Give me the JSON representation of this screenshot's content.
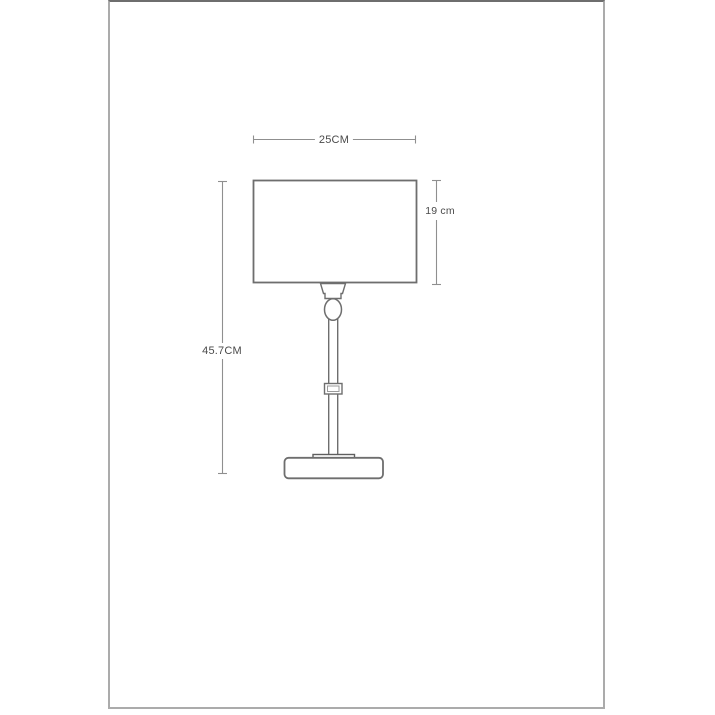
{
  "figure": {
    "type": "product-dimension-drawing",
    "subject": "table-lamp-line-drawing",
    "dimensions": {
      "width_label": "25CM",
      "shade_height_label": "19 cm",
      "total_height_label": "45.7CM"
    },
    "parts": [
      "lamp-shade",
      "socket-cup",
      "finial",
      "stem",
      "stem-collar",
      "base-plate",
      "base"
    ],
    "colors": {
      "background": "#ffffff",
      "frame_border": "#ababab",
      "frame_border_top": "#6e6e6e",
      "outline": "#6e6e6e",
      "dimension_line": "#8f8f8f",
      "label_text": "#4a4a4a"
    }
  }
}
